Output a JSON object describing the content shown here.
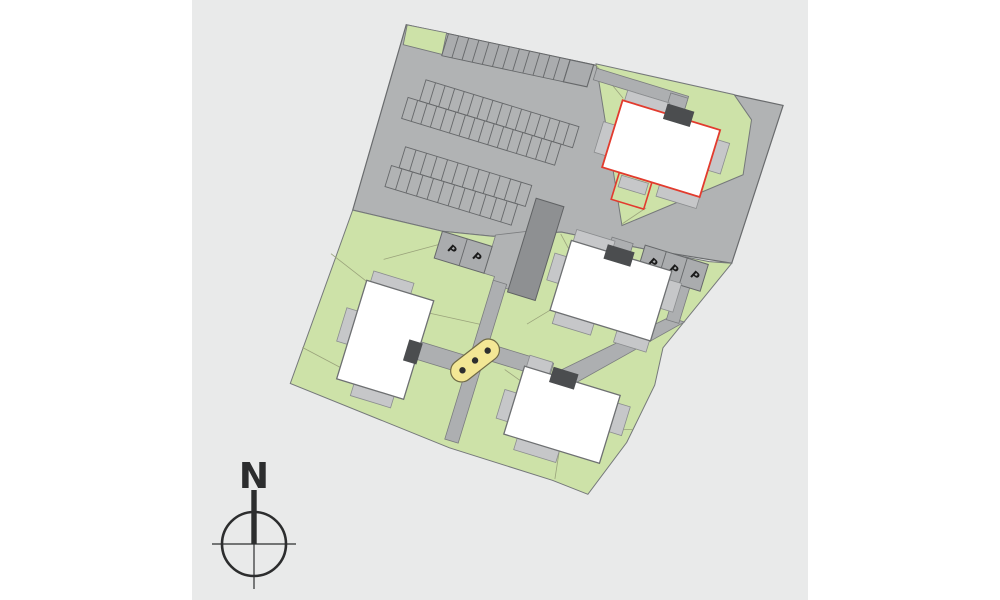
{
  "app": {
    "type": "architectural-site-plan"
  },
  "panel": {
    "left": 192,
    "width": 616
  },
  "palette": {
    "page_bg": "#ffffff",
    "canvas_bg": "#e9eaea",
    "asphalt": "#b1b3b4",
    "stall_fill": "#aaacae",
    "stall_line": "#66686a",
    "edge_dark": "#696b6d",
    "green": "#cde2a8",
    "green_line": "#9aa37b",
    "parcel_stroke": "#75787a",
    "building_fill": "#ffffff",
    "building_stroke": "#6e7072",
    "patio_fill": "#c6c7c9",
    "patio_stroke": "#8b8d8f",
    "entrance_fill": "#4b4d4f",
    "path_fill": "#adafb1",
    "path_stroke": "#7b7d7f",
    "outbuilding_fill": "#8e9092",
    "outbuilding_stroke": "#606264",
    "red_outline": "#e23b2e",
    "play_fill": "#f3e795",
    "play_stroke": "#6f6a45",
    "play_dot": "#2f2f2f",
    "compass": "#2c2d2e",
    "p_icon": "#1b1b1b"
  },
  "compass": {
    "label": "N"
  },
  "parking": {
    "stall_marker": "P",
    "rows": [
      {
        "id": "north-row",
        "stalls": 12,
        "wide_end_stall": true
      },
      {
        "id": "middle-row-upper",
        "stalls": 16
      },
      {
        "id": "middle-row-lower",
        "stalls": 16
      },
      {
        "id": "lower-row-upper",
        "stalls": 12
      },
      {
        "id": "lower-row-lower",
        "stalls": 12
      },
      {
        "id": "west-marked-stalls",
        "stalls": 2,
        "marked": true
      },
      {
        "id": "east-marked-stalls",
        "stalls": 3,
        "marked": true
      }
    ]
  },
  "buildings": [
    {
      "id": "building-northeast",
      "highlight": "red-outline",
      "annex": true
    },
    {
      "id": "building-central"
    },
    {
      "id": "building-west"
    },
    {
      "id": "building-south"
    }
  ],
  "site_features": {
    "play_equipment_dots": 3,
    "outbuilding": true,
    "rotation_deg": 17
  }
}
